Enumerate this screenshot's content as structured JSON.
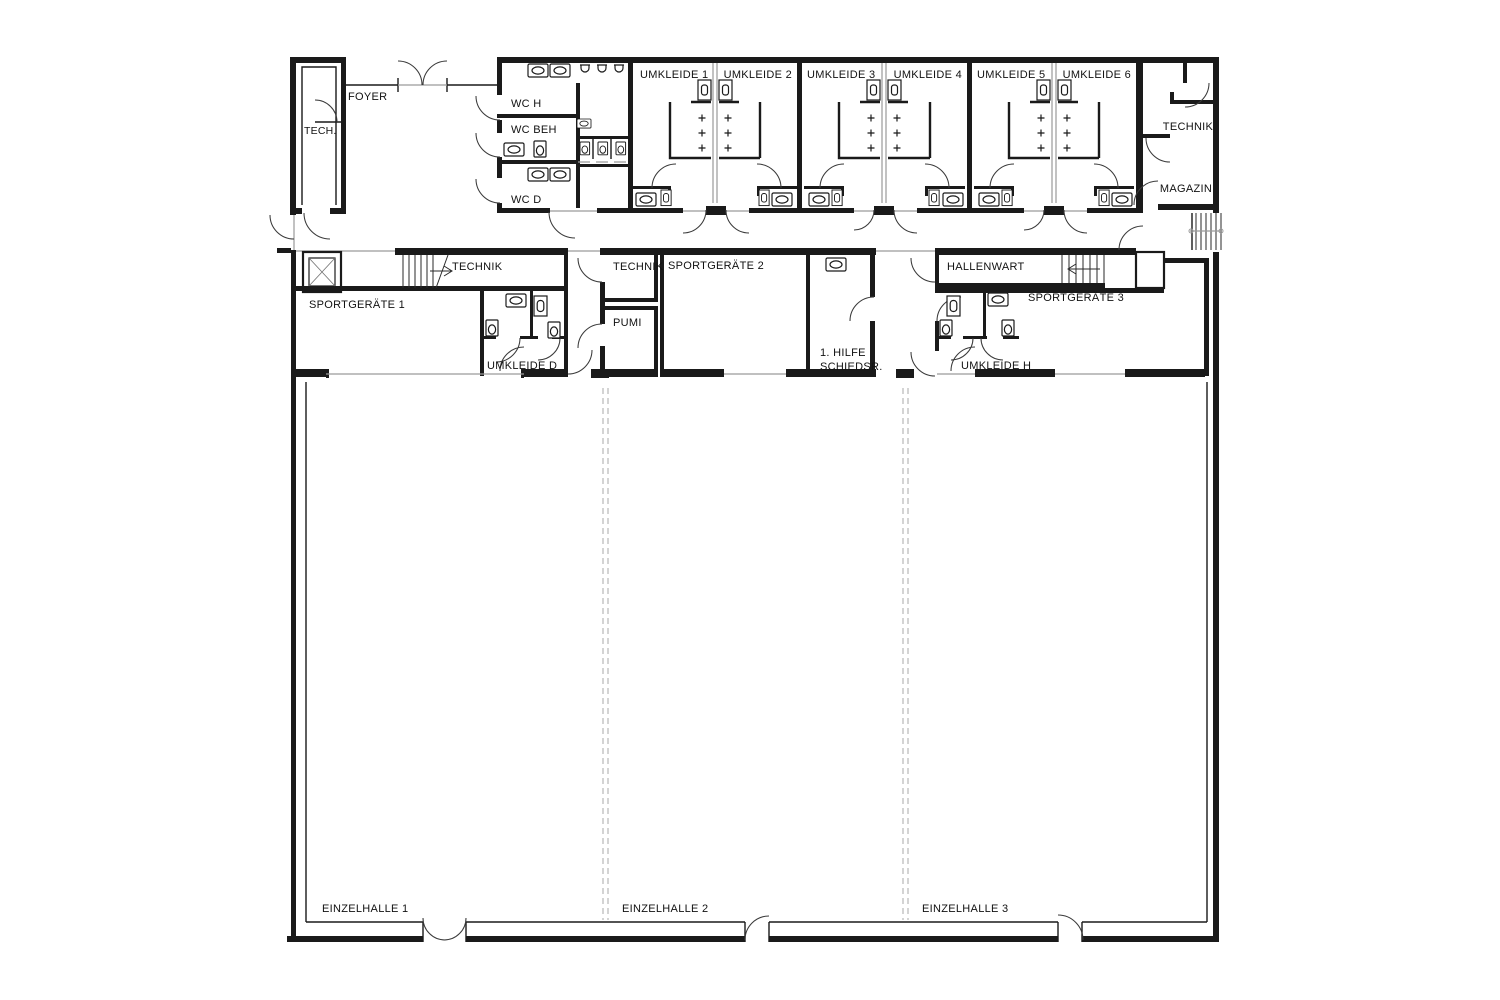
{
  "plan": {
    "type": "architectural-floor-plan",
    "building": "sports-hall-ground-floor"
  },
  "colors": {
    "wall": "#1a1a1a",
    "thin_line": "#3a3a3a",
    "gray_line": "#9a9a9a",
    "divider_dashed": "#b0b0b0",
    "background": "#ffffff"
  },
  "rooms": {
    "tech": "TECH.",
    "foyer": "FOYER",
    "wc_h": "WC H",
    "wc_beh": "WC BEH",
    "wc_d": "WC D",
    "umkleide_1": "UMKLEIDE 1",
    "umkleide_2": "UMKLEIDE 2",
    "umkleide_3": "UMKLEIDE 3",
    "umkleide_4": "UMKLEIDE 4",
    "umkleide_5": "UMKLEIDE 5",
    "umkleide_6": "UMKLEIDE 6",
    "technik_ne": "TECHNIK",
    "magazin": "MAGAZIN",
    "technik_stairs": "TECHNIK",
    "sportgeraete_1": "SPORTGERÄTE 1",
    "umkleide_d": "UMKLEIDE D",
    "technik_center": "TECHNIK",
    "sportgeraete_2": "SPORTGERÄTE 2",
    "pumi": "PUMI",
    "erste_hilfe_1": "1. HILFE",
    "erste_hilfe_2": "SCHIEDSR.",
    "hallenwart": "HALLENWART",
    "sportgeraete_3": "SPORTGERÄTE 3",
    "umkleide_h": "UMKLEIDE H",
    "einzelhalle_1": "EINZELHALLE 1",
    "einzelhalle_2": "EINZELHALLE 2",
    "einzelhalle_3": "EINZELHALLE 3"
  }
}
